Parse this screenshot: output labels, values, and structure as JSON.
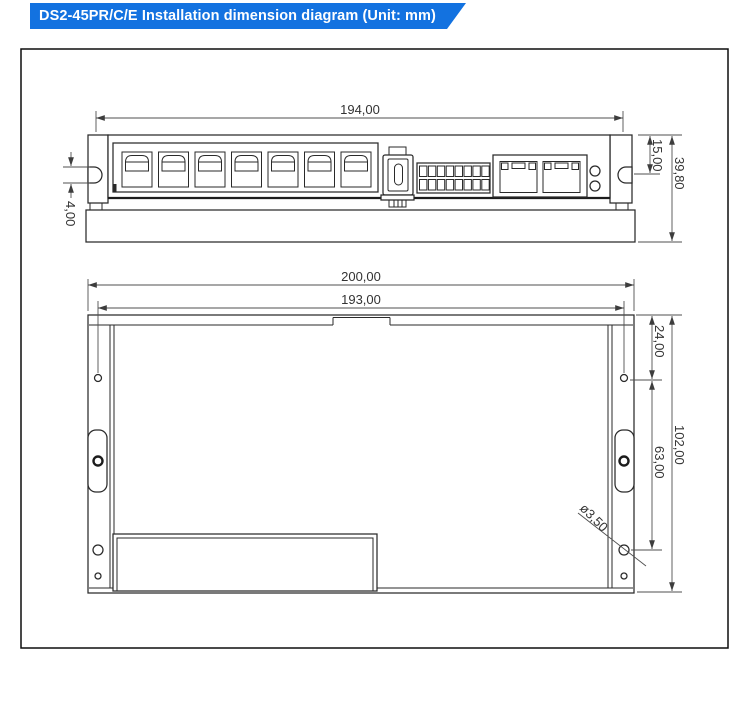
{
  "title_bar": {
    "text": "DS2-45PR/C/E Installation dimension diagram (Unit: mm)"
  },
  "colors": {
    "banner_bg": "#1372e0",
    "banner_text": "#ffffff",
    "line_color": "#2a2a2a",
    "dim_color": "#4f4f4f"
  },
  "top_view": {
    "dims": {
      "body_width": "194,00",
      "slot_gap": "4,00",
      "top_to_slot_center": "15,00",
      "overall_height": "39,80"
    }
  },
  "front_view": {
    "dims": {
      "overall_width": "200,00",
      "hole_spacing_horizontal": "193,00",
      "top_to_first_hole": "24,00",
      "hole_spacing_vertical": "63,00",
      "overall_height": "102,00",
      "hole_diameter": "ø3,50"
    }
  }
}
